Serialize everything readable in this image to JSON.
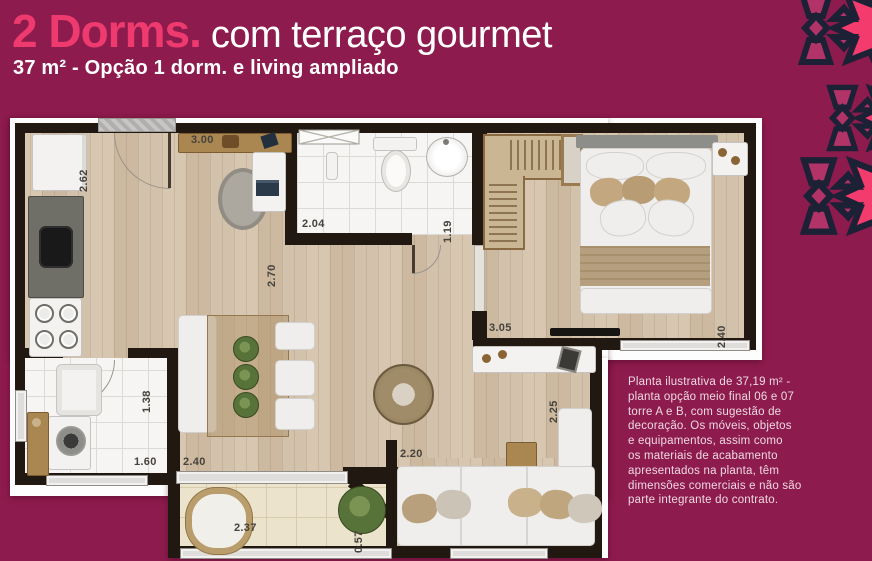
{
  "header": {
    "title_highlight": "2 Dorms.",
    "title_rest": "com terraço gourmet",
    "subtitle": "37 m² - Opção 1 dorm. e living ampliado"
  },
  "plan": {
    "labels": [
      {
        "text": "2.62"
      },
      {
        "text": "3.00"
      },
      {
        "text": "2.04"
      },
      {
        "text": "1.19"
      },
      {
        "text": "2.70"
      },
      {
        "text": "3.05"
      },
      {
        "text": "2.40"
      },
      {
        "text": "2.25"
      },
      {
        "text": "1.38"
      },
      {
        "text": "1.60"
      },
      {
        "text": "2.40"
      },
      {
        "text": "2.20"
      },
      {
        "text": "2.37"
      },
      {
        "text": "0.57"
      }
    ]
  },
  "disclaimer": "Planta ilustrativa de 37,19 m² -\nplanta opção meio final 06 e 07\ntorre A e B, com sugestão de\ndecoração. Os móveis, objetos\ne equipamentos, assim como\nos materiais de acabamento\napresentados na planta, têm\ndimensões comerciais e não são\nparte integrante do contrato.",
  "colors": {
    "background": "#8e1b4d",
    "accent_pink": "#ee3a6e",
    "pattern_pink": "#f43b6e",
    "pattern_muted": "#b23367",
    "pattern_outline": "#1c2136",
    "text_light": "#eed9e4"
  }
}
